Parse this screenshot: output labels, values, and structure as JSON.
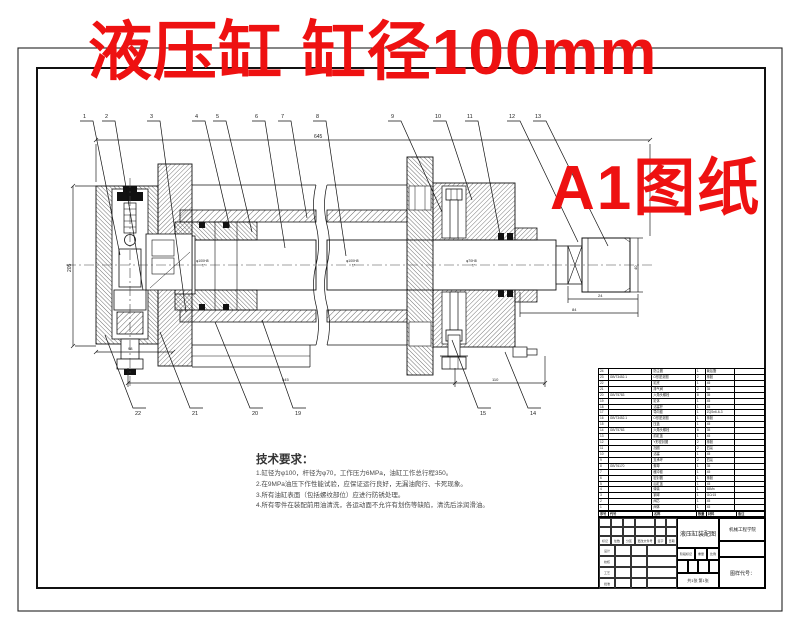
{
  "overlay": {
    "title": "液压缸  缸径100mm",
    "badge": "A1图纸",
    "color": "#ee1111"
  },
  "tech": {
    "heading": "技术要求：",
    "items": [
      "1.缸径为φ100，杆径为φ70，工作压力6MPa，油缸工作总行程350。",
      "2.在9MPa油压下作性能试验，应保证运行良好，无漏油爬行、卡死现象。",
      "3.所有油缸表面（包括螺纹部位）应进行防锈处理。",
      "4.所有零件在装配前用油清洗，各运动面不允许有划伤等缺陷，清洗后涂润滑油。"
    ]
  },
  "callouts": {
    "top": [
      "1",
      "2",
      "3",
      "4",
      "5",
      "6",
      "7",
      "8",
      "9",
      "10",
      "11",
      "12",
      "13"
    ],
    "bottom": [
      "22",
      "21",
      "20",
      "19",
      "15",
      "14"
    ]
  },
  "dims": {
    "overall": "645",
    "height": "205",
    "bottom_left": "98",
    "bottom_main": "545",
    "bottom_right": "110",
    "rod_a": "24",
    "rod_b": "84",
    "rod_d": "40",
    "fit_bore": "φ100H8",
    "fit_bore2": "f7",
    "fit_rod": "φ70H8",
    "fit_rod2": "f7"
  },
  "bom": {
    "headers": [
      "序号",
      "代号",
      "名称",
      "数量",
      "材料",
      "备注"
    ],
    "rows": [
      [
        "24",
        "",
        "防尘圈",
        "1",
        "聚氨酯",
        ""
      ],
      [
        "23",
        "GB/T3452.1",
        "O形密封圈",
        "2",
        "橡胶",
        ""
      ],
      [
        "22",
        "",
        "缸底",
        "1",
        "45",
        ""
      ],
      [
        "21",
        "",
        "排气阀",
        "2",
        "35",
        ""
      ],
      [
        "20",
        "GB/T5783",
        "六角头螺栓",
        "8",
        "35",
        ""
      ],
      [
        "19",
        "",
        "缸体",
        "1",
        "45",
        ""
      ],
      [
        "18",
        "",
        "活塞杆",
        "1",
        "45",
        ""
      ],
      [
        "17",
        "",
        "导向套",
        "1",
        "ZQSn6-6-3",
        ""
      ],
      [
        "16",
        "GB/T3452.1",
        "O形密封圈",
        "1",
        "橡胶",
        ""
      ],
      [
        "15",
        "",
        "压盖",
        "1",
        "45",
        ""
      ],
      [
        "14",
        "GB/T5783",
        "六角头螺栓",
        "6",
        "35",
        ""
      ],
      [
        "13",
        "",
        "前缸盖",
        "1",
        "45",
        ""
      ],
      [
        "12",
        "",
        "Y形密封圈",
        "2",
        "橡胶",
        ""
      ],
      [
        "11",
        "",
        "挡圈",
        "2",
        "四氟",
        ""
      ],
      [
        "10",
        "",
        "活塞",
        "1",
        "45",
        ""
      ],
      [
        "9",
        "",
        "支承环",
        "2",
        "四氟",
        ""
      ],
      [
        "8",
        "GB/T6170",
        "螺母",
        "1",
        "35",
        ""
      ],
      [
        "7",
        "",
        "缓冲套",
        "1",
        "45",
        ""
      ],
      [
        "6",
        "",
        "密封圈",
        "1",
        "橡胶",
        ""
      ],
      [
        "5",
        "",
        "后缸盖",
        "1",
        "45",
        ""
      ],
      [
        "4",
        "",
        "弹簧",
        "1",
        "65Mn",
        ""
      ],
      [
        "3",
        "",
        "钢球",
        "1",
        "GCr15",
        ""
      ],
      [
        "2",
        "",
        "阀芯",
        "1",
        "45",
        ""
      ],
      [
        "1",
        "",
        "阀体",
        "1",
        "45",
        ""
      ]
    ]
  },
  "title_block": {
    "drawing_title": "液压缸装配图",
    "org": "机械工程学院",
    "code_label": "图样代号：",
    "stage": "阶段标记",
    "weight": "重量",
    "scale": "比例",
    "sheets": "共1张 第1张",
    "mark": "标记",
    "count": "处数",
    "zone": "分区",
    "change": "更改文件号",
    "sign": "签字",
    "date": "日期",
    "design": "设计",
    "check": "校核",
    "process": "工艺",
    "approve": "批准"
  }
}
